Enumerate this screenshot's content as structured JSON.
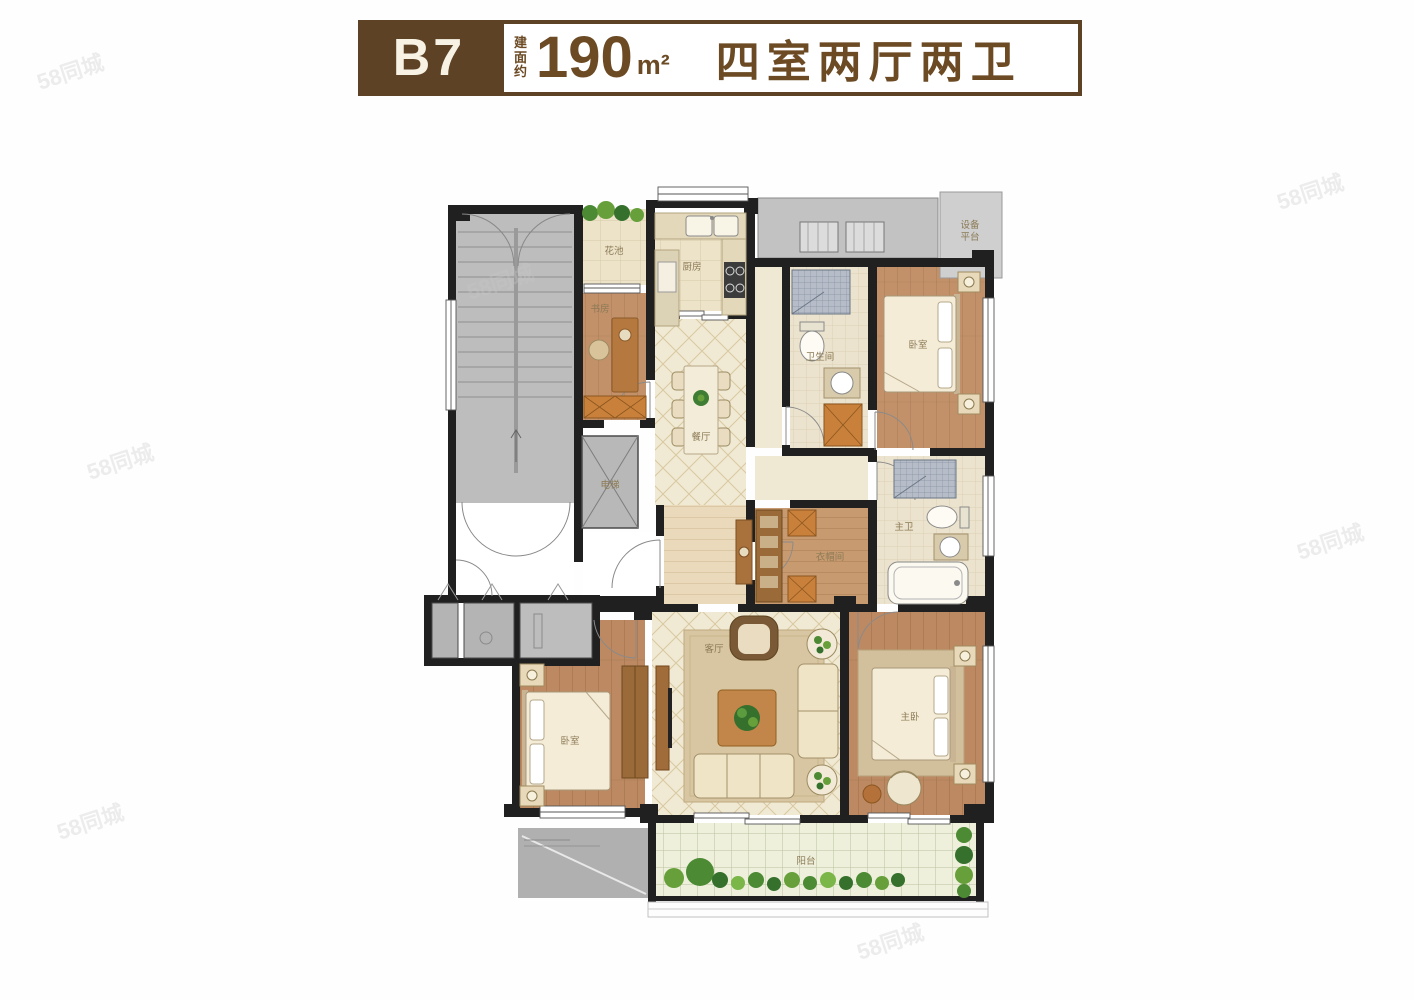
{
  "header": {
    "unit_code": "B7",
    "area_label": "建面约",
    "area_value": "190",
    "area_unit": "m²",
    "layout_text": "四室两厅两卫"
  },
  "watermark": "58同城",
  "rooms": {
    "study": "书房",
    "kitchen": "厨房",
    "dining": "餐厅",
    "living": "客厅",
    "bedroom_top": "卧室",
    "bedroom_left": "卧室",
    "master_bedroom": "主卧",
    "closet": "衣帽间",
    "bath_guest": "卫生间",
    "bath_master": "主卫",
    "balcony": "阳台",
    "flower_box": "花池",
    "elevator": "电梯",
    "equipment_line1": "设备",
    "equipment_line2": "平台"
  },
  "colors": {
    "brand_brown": "#5d4226",
    "wall_black": "#202020",
    "wood_floor": "#c2916a",
    "cream_tile": "#ece3c9",
    "gray_block": "#b8b8b8",
    "plant_green": "#4c8a33"
  }
}
